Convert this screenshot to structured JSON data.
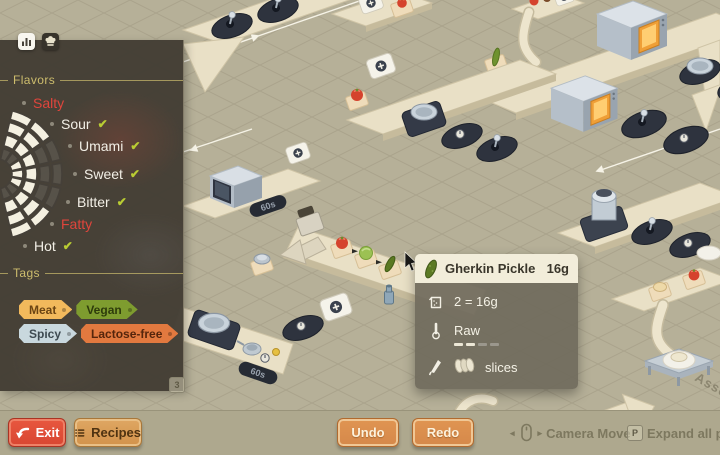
{
  "panel": {
    "tabs": [
      {
        "name": "stats"
      },
      {
        "name": "recipe-book"
      }
    ],
    "flavors": {
      "title": "Flavors",
      "items": [
        {
          "label": "Salty",
          "checked": false,
          "warn": true
        },
        {
          "label": "Sour",
          "checked": true,
          "warn": false
        },
        {
          "label": "Umami",
          "checked": true,
          "warn": false
        },
        {
          "label": "Sweet",
          "checked": true,
          "warn": false
        },
        {
          "label": "Bitter",
          "checked": true,
          "warn": false
        },
        {
          "label": "Fatty",
          "checked": false,
          "warn": true
        },
        {
          "label": "Hot",
          "checked": true,
          "warn": false
        }
      ],
      "wheel": {
        "rings": 4,
        "filled_rings": [
          [
            2,
            3,
            4
          ],
          [
            2,
            3,
            4
          ],
          [
            1,
            2
          ],
          [
            1,
            2
          ],
          [
            1,
            2
          ],
          [
            2,
            3,
            4
          ],
          [
            2,
            3,
            4
          ]
        ]
      }
    },
    "tags": {
      "title": "Tags",
      "items": [
        {
          "label": "Meat",
          "bg": "#f2b95c",
          "fg": "#6b4413"
        },
        {
          "label": "Vegan",
          "bg": "#7e9c2f",
          "fg": "#2e3c0b"
        },
        {
          "label": "Spicy",
          "bg": "#c9d8de",
          "fg": "#3e4a51"
        },
        {
          "label": "Lactose-free",
          "bg": "#e2793f",
          "fg": "#55250c"
        }
      ]
    },
    "shortcut_badge": "3"
  },
  "tooltip": {
    "title": "Gherkin Pickle",
    "weight": "16g",
    "quantity": "2 = 16g",
    "state": "Raw",
    "state_progress": {
      "filled": 2,
      "total": 4
    },
    "prep": "slices"
  },
  "bottom_bar": {
    "exit_label": "Exit",
    "recipes_label": "Recipes",
    "undo_label": "Undo",
    "redo_label": "Redo",
    "camera_move_label": "Camera Move",
    "expand_label": "Expand all path",
    "expand_key": "P"
  },
  "scene": {
    "timer_display": "60s",
    "floor_label": "Asse"
  },
  "icons": {
    "check": "✔",
    "arrow_left": "◂",
    "arrow_right": "▸"
  },
  "colors": {
    "flavor_warn": "#e0453c",
    "check_green": "#b9cc33",
    "section_gold": "#cdbd6d",
    "exit_red": "#e1503a",
    "button_orange": "#dd9050",
    "recipes_tan": "#d9a05f",
    "panel_dark": "#46413a",
    "floor_tan": "#b6b098",
    "tooltip_header": "#f2edda"
  }
}
